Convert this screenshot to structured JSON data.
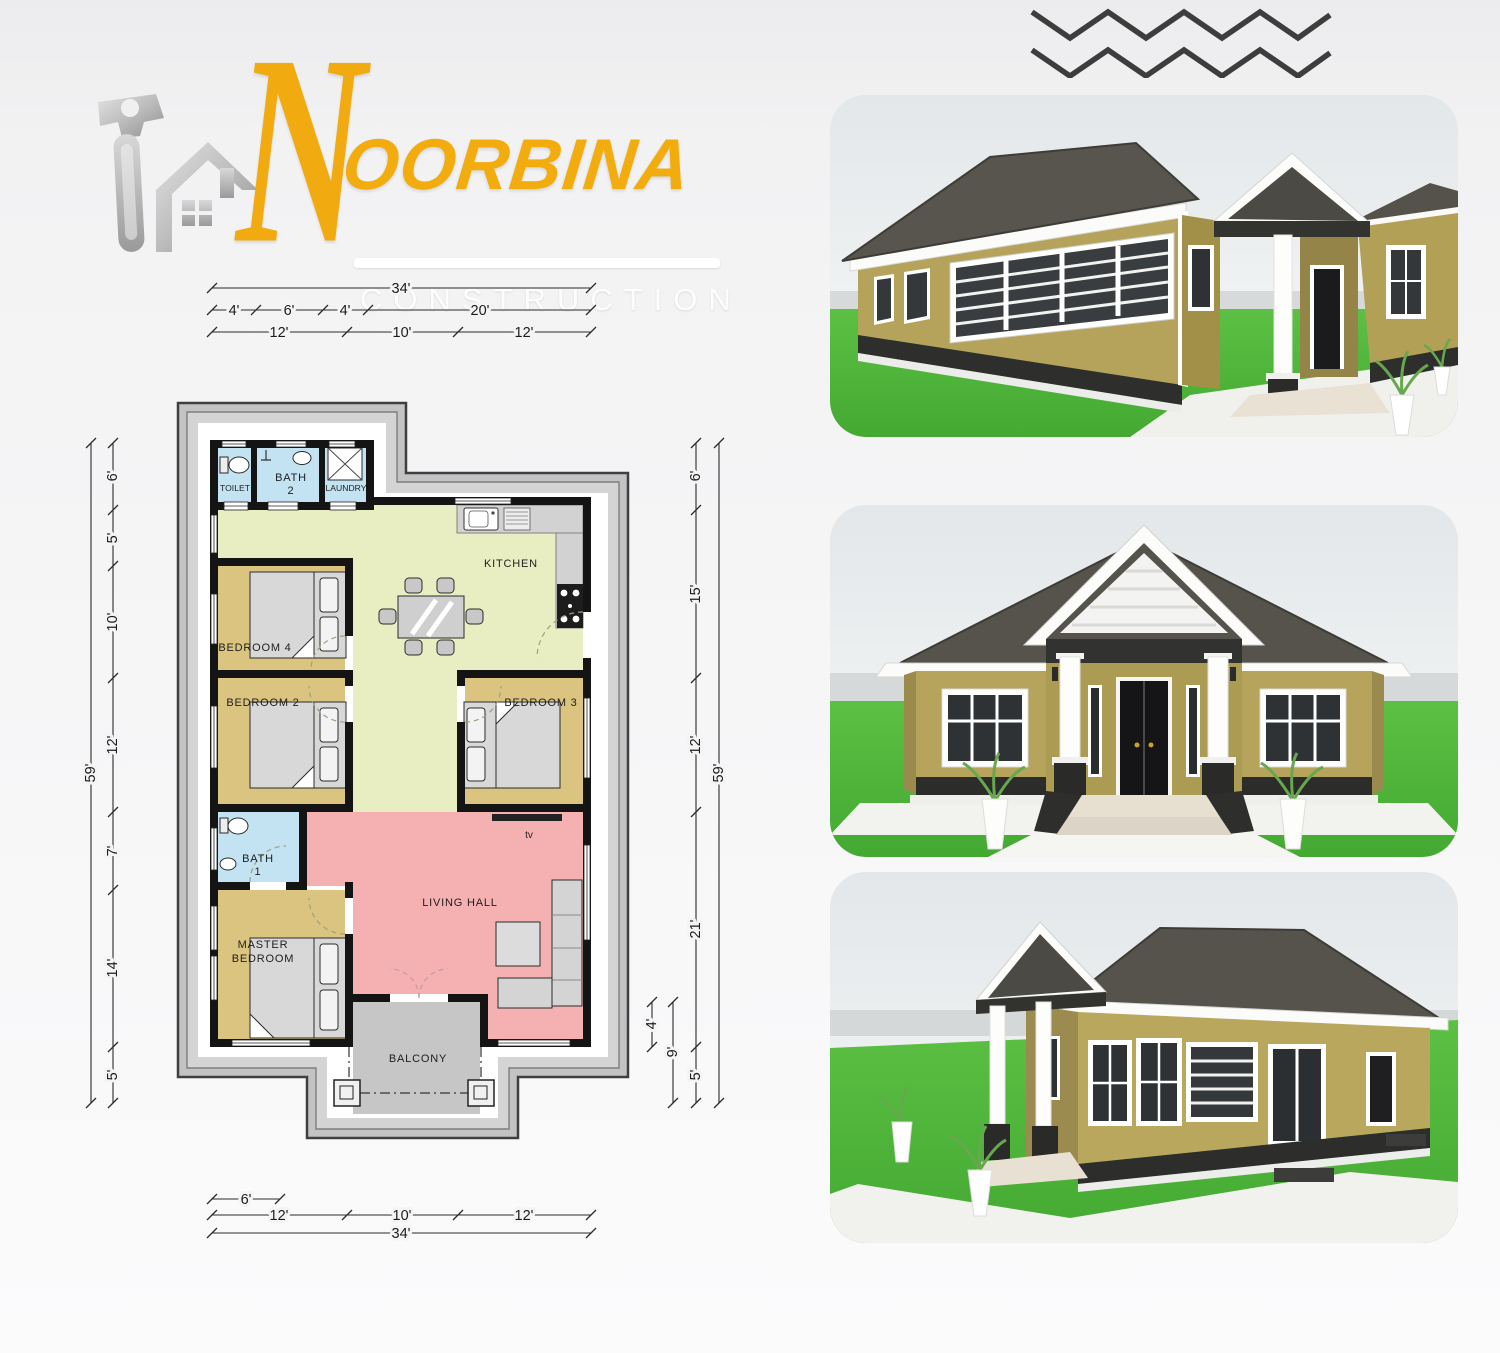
{
  "logo": {
    "initial": "N",
    "name": "OORBINA",
    "subtitle": "CONSTRUCTION",
    "icon": "hammer-house-icon",
    "brand_yellow": "#f2ac0e",
    "brand_silver": "#b9b9b9"
  },
  "decoration": {
    "zigzag_lines": 2,
    "color": "#3d3d3d"
  },
  "plan": {
    "rooms": {
      "toilet": "TOILET",
      "bath2_line1": "BATH",
      "bath2_line2": "2",
      "laundry": "LAUNDRY",
      "kitchen": "KITCHEN",
      "bedroom4": "BEDROOM  4",
      "bedroom2": "BEDROOM  2",
      "bedroom3": "BEDROOM  3",
      "bath1_line1": "BATH",
      "bath1_line2": "1",
      "master_line1": "MASTER",
      "master_line2": "BEDROOM",
      "living": "LIVING  HALL",
      "tv": "tv",
      "balcony": "BALCONY"
    },
    "dims": {
      "top": {
        "total": "34'",
        "row2": [
          "4'",
          "6'",
          "4'",
          "20'"
        ],
        "row3": [
          "12'",
          "10'",
          "12'"
        ]
      },
      "bottom": {
        "row1": "6'",
        "row2": [
          "12'",
          "10'",
          "12'"
        ],
        "total": "34'"
      },
      "left": {
        "total": "59'",
        "segments": [
          "6'",
          "5'",
          "10'",
          "12'",
          "7'",
          "14'",
          "5'"
        ]
      },
      "right": {
        "total": "59'",
        "segments": [
          "6'",
          "15'",
          "12'",
          "21'",
          "5'"
        ],
        "porch": [
          "4'",
          "9'"
        ]
      }
    },
    "colors": {
      "bath_blue": "#c3e3f2",
      "bedroom_tan": "#dbc47f",
      "kitchen_green": "#e8eec2",
      "living_pink": "#f5b1b2",
      "apron_gray": "#c3c3c3",
      "wall_black": "#141414"
    }
  },
  "renders": [
    {
      "name": "side-perspective-render"
    },
    {
      "name": "front-elevation-render"
    },
    {
      "name": "rear-corner-perspective-render"
    }
  ],
  "render_colors": {
    "wall_khaki": "#b5a35b",
    "roof_dark": "#55534b",
    "grass_green": "#4fb53b",
    "trim_white": "#fbfbfa",
    "plinth_dark": "#2d2d2b",
    "sky_gray": "#e3e7e9"
  }
}
